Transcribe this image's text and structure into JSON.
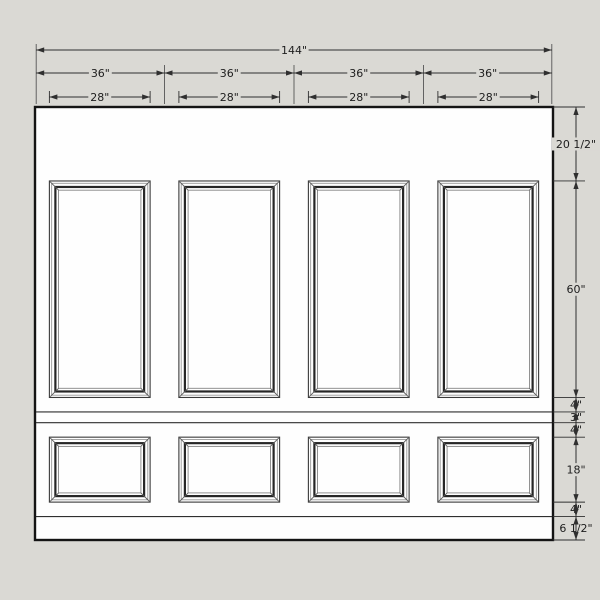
{
  "drawing": {
    "type": "wall-elevation-wainscoting",
    "units": "inches",
    "background": "#dad9d4",
    "wall_fill": "#fefefe",
    "wall_outline_color": "#141414",
    "line_color": "#2f2f2f",
    "extension_line_color": "#555555",
    "text_color": "#1d1d1d",
    "total_width_label": "144\"",
    "total_width_in": 144,
    "bays": [
      {
        "width_label": "36\"",
        "width_in": 36,
        "panel_width_label": "28\"",
        "panel_width_in": 28
      },
      {
        "width_label": "36\"",
        "width_in": 36,
        "panel_width_label": "28\"",
        "panel_width_in": 28
      },
      {
        "width_label": "36\"",
        "width_in": 36,
        "panel_width_label": "28\"",
        "panel_width_in": 28
      },
      {
        "width_label": "36\"",
        "width_in": 36,
        "panel_width_label": "28\"",
        "panel_width_in": 28
      }
    ],
    "vertical_sections": [
      {
        "label": "20 1/2\"",
        "inches": 20.5,
        "description": "frieze above tall panels"
      },
      {
        "label": "60\"",
        "inches": 60,
        "description": "tall panel height"
      },
      {
        "label": "4\"",
        "inches": 4,
        "description": "rail below tall panels"
      },
      {
        "label": "3\"",
        "inches": 3,
        "description": "chair rail band"
      },
      {
        "label": "4\"",
        "inches": 4,
        "description": "rail above short panels"
      },
      {
        "label": "18\"",
        "inches": 18,
        "description": "short panel height"
      },
      {
        "label": "4\"",
        "inches": 4,
        "description": "rail below short panels"
      },
      {
        "label": "6 1/2\"",
        "inches": 6.5,
        "description": "baseboard"
      }
    ],
    "panels": {
      "tall": {
        "count": 4,
        "width_in": 28,
        "height_in": 60
      },
      "short": {
        "count": 4,
        "width_in": 28,
        "height_in": 18
      }
    }
  }
}
